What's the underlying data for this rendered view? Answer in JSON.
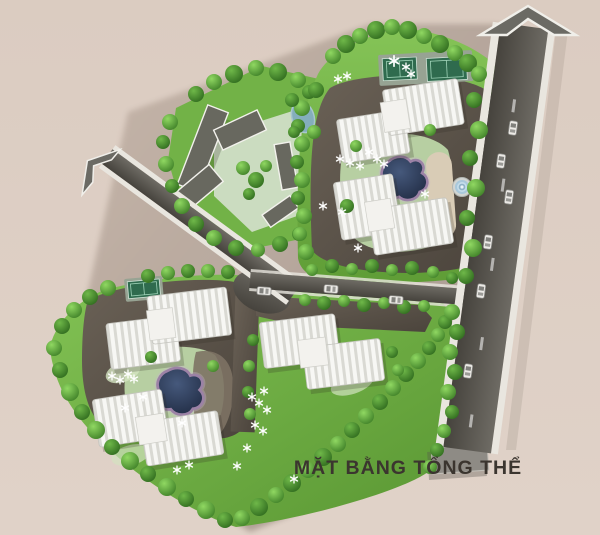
{
  "title": {
    "text": "MẶT BẰNG TỔNG THỂ"
  },
  "theme": {
    "background": "#dccdc2",
    "parcel_shadow": "#b2a297",
    "grass": "#6fb244",
    "grass_light": "#cbdcc0",
    "plaza": "#575047",
    "road": "#52504b",
    "sidewalk": "#e9e6df",
    "building_roof": "#f6f6f3",
    "building_rib": "#dcdcd6",
    "lowrise": "#68685f",
    "pond": "#28334d",
    "pond_rim": "#9c82a6",
    "tennis_court": "#2f6b4e",
    "tree_light": "#7cc94f",
    "tree_dark": "#3e7f27",
    "arrow": "#6b6a64",
    "title_color": "#3b352f"
  },
  "features": {
    "arrows": [
      {
        "name": "north-road-arrow",
        "direction": "up"
      },
      {
        "name": "west-road-arrow",
        "direction": "up-left"
      }
    ],
    "roads": [
      "main-road",
      "west-access-road",
      "internal-road"
    ],
    "clusters": [
      {
        "name": "north-residential-cluster",
        "towers": 4,
        "amenities": [
          "pond",
          "fountain",
          "tennis-courts"
        ]
      },
      {
        "name": "southwest-residential-cluster",
        "towers": 4,
        "amenities": [
          "pond",
          "tennis-court"
        ]
      },
      {
        "name": "central-residential-pair",
        "towers": 2,
        "amenities": [
          "lawns"
        ]
      },
      {
        "name": "low-rise-compound",
        "buildings": 5,
        "amenities": [
          "courtyard",
          "small-pond"
        ]
      }
    ],
    "ponds": 2,
    "fountains": 1,
    "tennis_courts": 3,
    "vehicles": 9
  }
}
